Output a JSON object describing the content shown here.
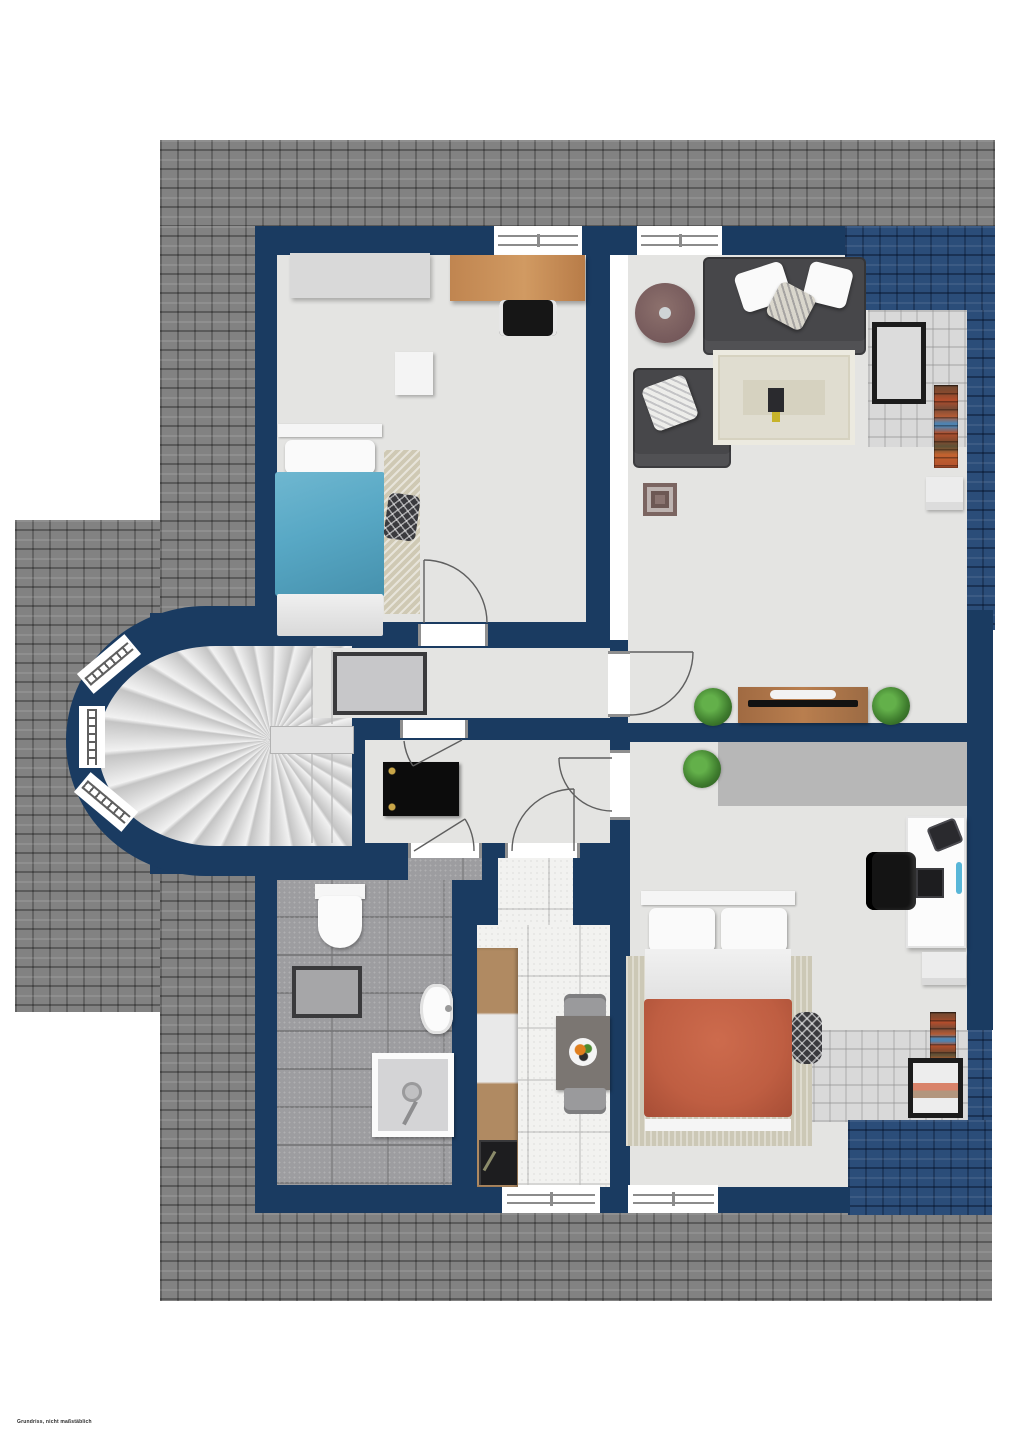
{
  "document": {
    "type": "floor-plan-attic-storey",
    "footer_note": "Grundriss, nicht maßstäblich"
  },
  "palette": {
    "wall": "#1a3b61",
    "roofGray": "#828282",
    "roofBlue": "#2b4d79",
    "floor": "#e4e4e2",
    "floorBath": "#9d9da0",
    "floorKitchen": "#f2f2f0",
    "overlayTile": "#d8d8d8",
    "bedBlue": "#58a8c5",
    "bedRed": "#bf5e42",
    "wood": "#b0854f",
    "woodDark": "#9c6b44",
    "sofa": "#47474a",
    "rugBeige": "#d6d2c0",
    "plant": "#3f7d2e",
    "gold": "#c9a648",
    "frameDark": "#1c1c1c",
    "chairGray": "#9a9a9c"
  },
  "rooms": [
    {
      "id": "bedroom-top-left",
      "contents": [
        "dresser",
        "wooden-desk",
        "office-chair",
        "single-bed-blue",
        "runner-rug",
        "patterned-pillow"
      ]
    },
    {
      "id": "living-room",
      "contents": [
        "round-table",
        "sofa",
        "armchair",
        "area-rug",
        "wall-mirror",
        "bookshelf",
        "side-table",
        "tv-sideboard",
        "plants"
      ]
    },
    {
      "id": "hallway",
      "contents": [
        "framed-rug",
        "fan-staircase"
      ]
    },
    {
      "id": "vestibule",
      "contents": [
        "black-doormat"
      ]
    },
    {
      "id": "bathroom",
      "contents": [
        "toilet",
        "bath-mat",
        "washbasin",
        "shower"
      ]
    },
    {
      "id": "kitchen",
      "contents": [
        "counter-with-sink-and-stove",
        "dining-table",
        "chairs",
        "fruit-plate"
      ]
    },
    {
      "id": "bedroom-bottom-right",
      "contents": [
        "double-bed-red",
        "area-rug",
        "desk",
        "office-chair",
        "monitor",
        "phone",
        "plant",
        "mirror",
        "shelf"
      ]
    }
  ],
  "openings": {
    "windows": 7,
    "doors": 6,
    "bay_windows": 3
  }
}
